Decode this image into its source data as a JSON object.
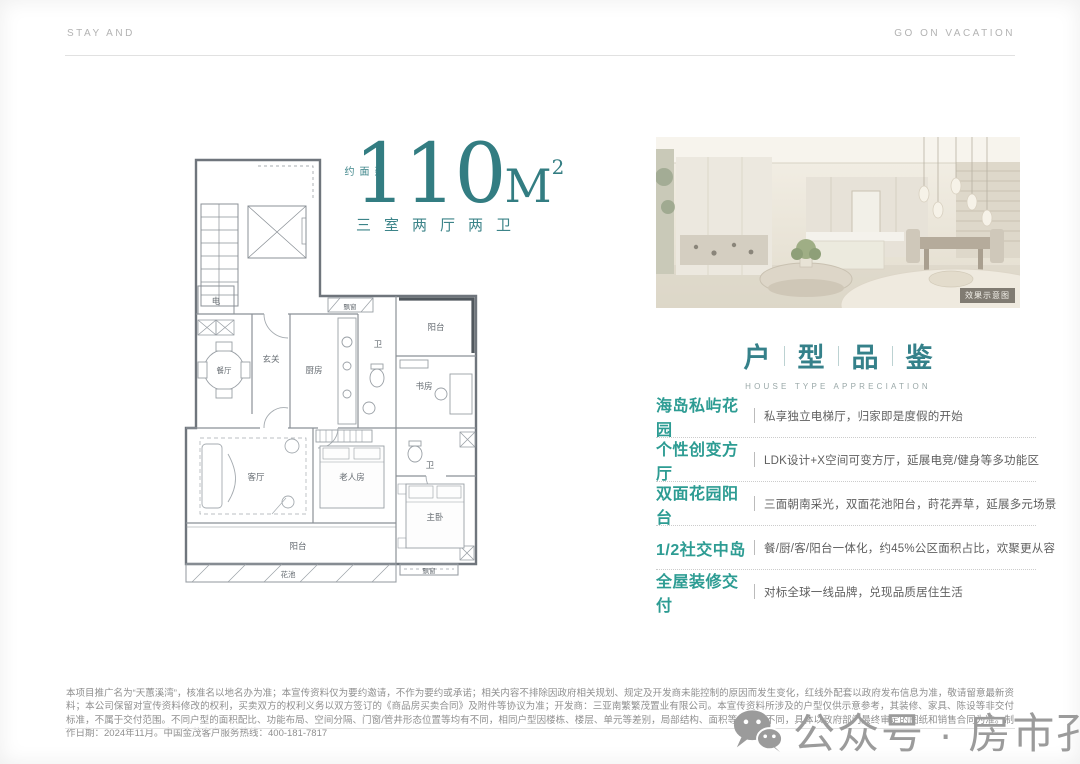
{
  "colors": {
    "accent": "#337D82",
    "feature_accent": "#2D9C93",
    "text_gray": "#5F5F5F",
    "watermark_gray": "#9B9B9B"
  },
  "header": {
    "left": "STAY AND",
    "right": "GO ON VACATION"
  },
  "title": {
    "prefix": "建面约",
    "area": "110",
    "unit": "M",
    "sup": "2",
    "subtitle": "三室两厅两卫"
  },
  "floor_plan": {
    "labels": [
      "电",
      "玄关",
      "厨房",
      "飘窗",
      "卫",
      "阳台",
      "书房",
      "卫",
      "餐厅",
      "客厅",
      "老人房",
      "主卧",
      "阳台",
      "花池",
      "飘窗"
    ]
  },
  "photo": {
    "caption": "效果示意图"
  },
  "section": {
    "chars": [
      "户",
      "型",
      "品",
      "鉴"
    ],
    "subtitle": "HOUSE TYPE APPRECIATION"
  },
  "features": [
    {
      "heading": "海岛私屿花园",
      "desc": "私享独立电梯厅，归家即是度假的开始"
    },
    {
      "heading": "个性创变方厅",
      "desc": "LDK设计+X空间可变方厅，延展电竞/健身等多功能区"
    },
    {
      "heading": "双面花园阳台",
      "desc": "三面朝南采光，双面花池阳台，莳花弄草，延展多元场景"
    },
    {
      "heading": "1/2社交中岛",
      "desc": "餐/厨/客/阳台一体化，约45%公区面积占比，欢聚更从容"
    },
    {
      "heading": "全屋装修交付",
      "desc": "对标全球一线品牌，兑现品质居住生活"
    }
  ],
  "disclaimer": "本项目推广名为“天蕙溪湾”，核准名以地名办为准；本宣传资料仅为要约邀请，不作为要约或承诺；相关内容不排除因政府相关规划、规定及开发商未能控制的原因而发生变化，红线外配套以政府发布信息为准，敬请留意最新资料；本公司保留对宣传资料修改的权利，买卖双方的权利义务以双方签订的《商品房买卖合同》及附件等协议为准；开发商：三亚南繁繁茂置业有限公司。本宣传资料所涉及的户型仅供示意参考，其装修、家具、陈设等非交付标准，不属于交付范围。不同户型的面积配比、功能布局、空间分隔、门窗/管井形态位置等均有不同，相同户型因楼栋、楼层、单元等差别，局部结构、面积等也可能不同，具体以政府部门最终审定的图纸和销售合同为准。制作日期：2024年11月。中国金茂客户服务热线：400-181-7817",
  "watermark": {
    "text": "公众号 · 房市孔明"
  }
}
